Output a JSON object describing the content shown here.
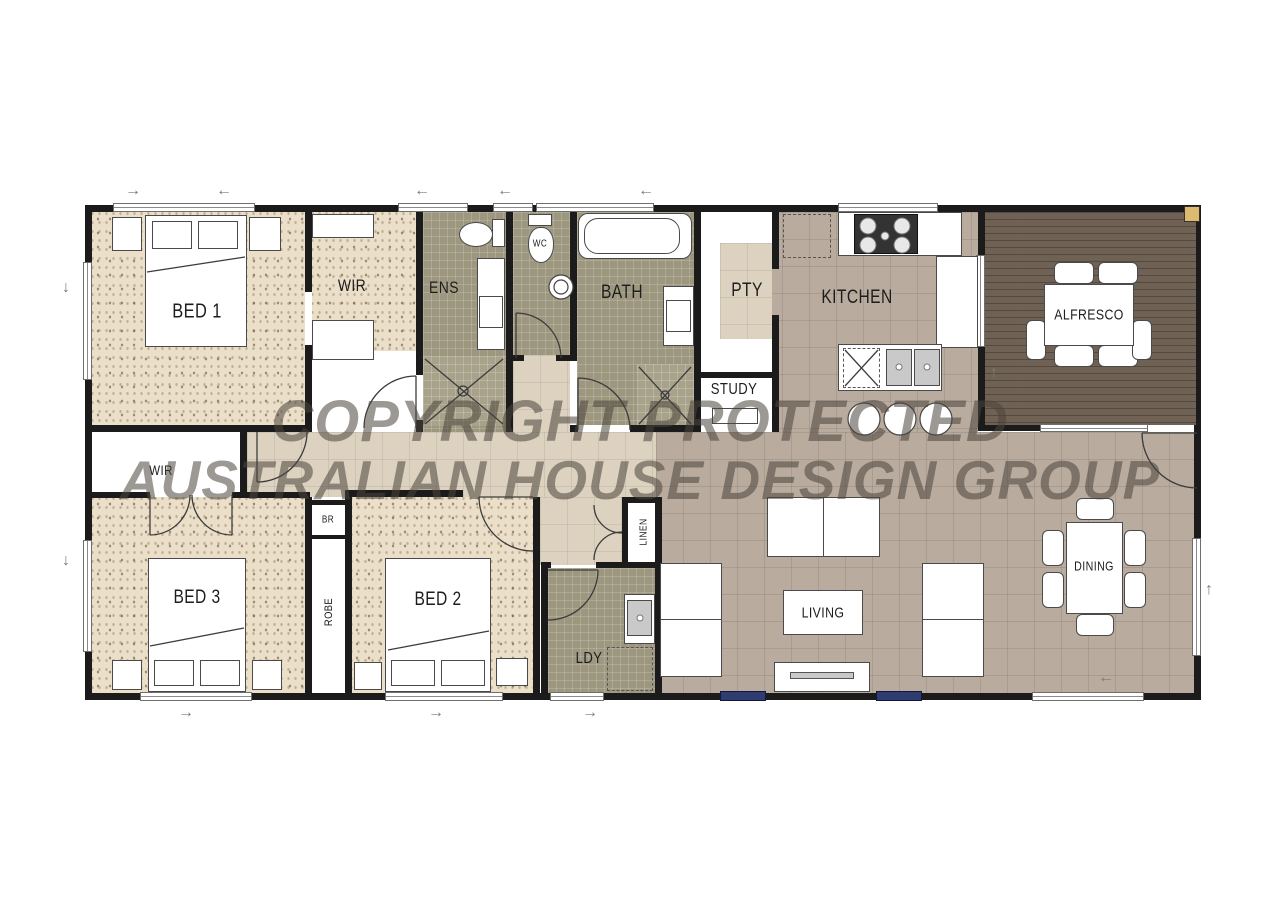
{
  "watermark": {
    "line1": "COPYRIGHT PROTECTED",
    "line2": "AUSTRALIAN HOUSE DESIGN GROUP"
  },
  "rooms": {
    "bed1": {
      "label": "BED 1"
    },
    "wir1": {
      "label": "WIR"
    },
    "ens": {
      "label": "ENS"
    },
    "wc": {
      "label": "WC"
    },
    "bath": {
      "label": "BATH"
    },
    "pty": {
      "label": "PTY"
    },
    "kitchen": {
      "label": "KITCHEN"
    },
    "alfresco": {
      "label": "ALFRESCO"
    },
    "study": {
      "label": "STUDY"
    },
    "wir3": {
      "label": "WIR"
    },
    "bed3": {
      "label": "BED 3"
    },
    "br": {
      "label": "BR"
    },
    "robe": {
      "label": "ROBE"
    },
    "bed2": {
      "label": "BED 2"
    },
    "linen": {
      "label": "LINEN"
    },
    "ldy": {
      "label": "LDY"
    },
    "living": {
      "label": "LIVING"
    },
    "dining": {
      "label": "DINING"
    }
  },
  "icons": {
    "arrow_left": "←",
    "arrow_right": "→",
    "arrow_up": "↑",
    "arrow_down": "↓"
  },
  "palette": {
    "wall": "#1b1b1b",
    "bedroom_floor": "#ebdfc9",
    "wet_area_floor": "#9d977f",
    "tile_floor": "#b9ac9e",
    "hall_floor": "#ddd2c0",
    "deck_floor": "#6f6255",
    "window_accent": "#2f3c70",
    "post": "#dcba6e",
    "watermark_color": "#4a443d"
  }
}
